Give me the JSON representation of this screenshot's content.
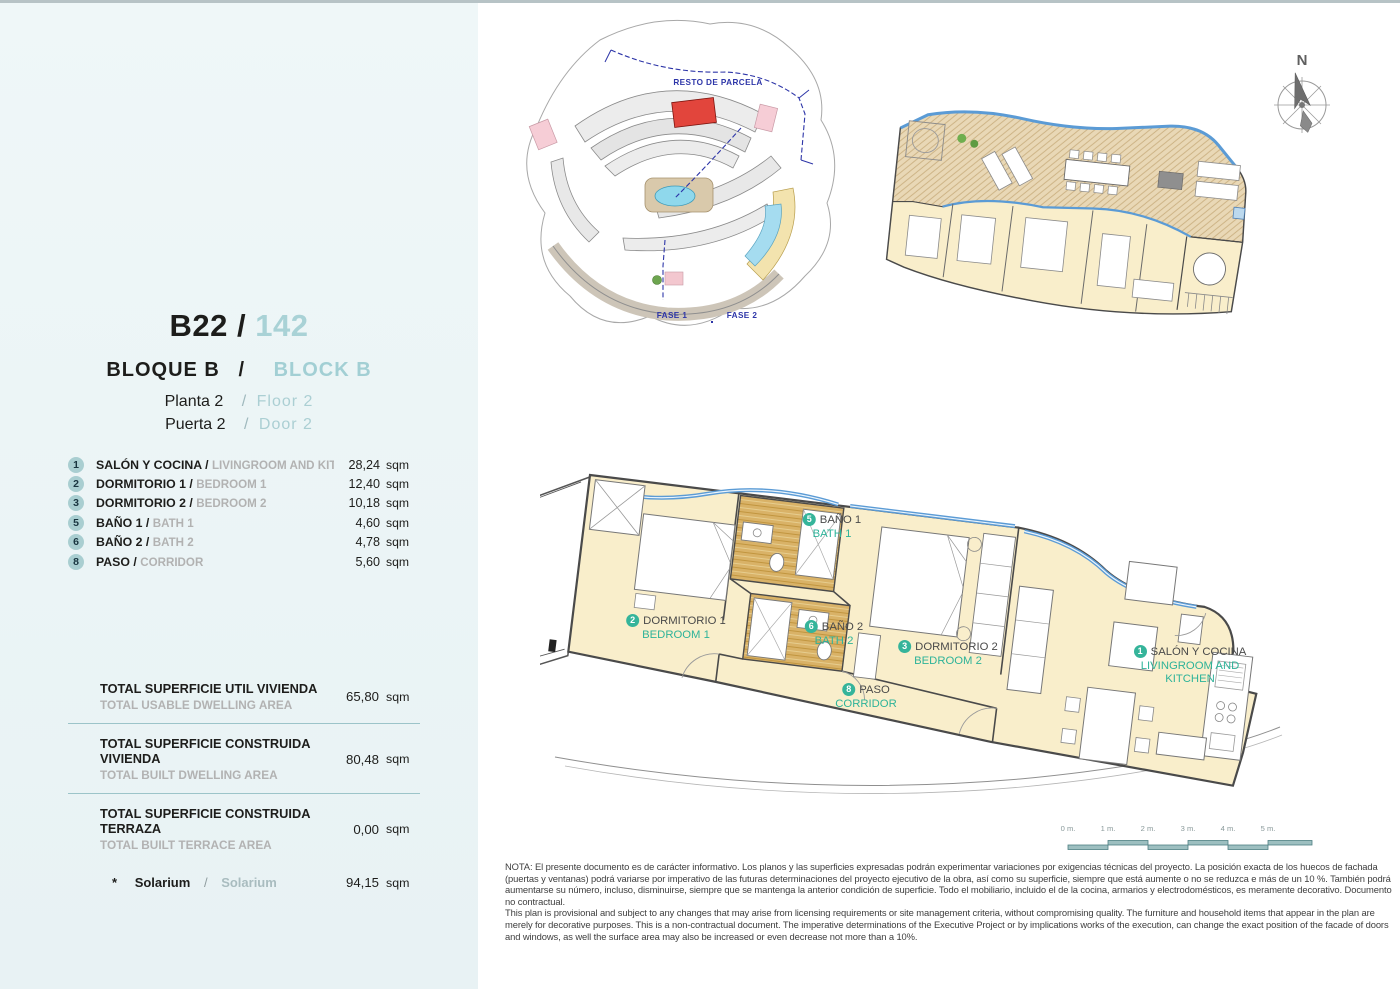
{
  "ui": {
    "slash": "/"
  },
  "sidebar": {
    "unit": {
      "code": "B22 /",
      "number": "142"
    },
    "block": {
      "es": "BLOQUE  B",
      "en": "BLOCK  B"
    },
    "floor": {
      "es": "Planta 2",
      "en": "Floor  2"
    },
    "door": {
      "es": "Puerta 2",
      "en": "Door  2"
    },
    "rooms": [
      {
        "num": "1",
        "name_es": "SALÓN Y COCINA /",
        "name_en": "LIVINGROOM AND KITCHEN",
        "area": "28,24",
        "unit": "sqm"
      },
      {
        "num": "2",
        "name_es": "DORMITORIO 1 /",
        "name_en": "BEDROOM 1",
        "area": "12,40",
        "unit": "sqm"
      },
      {
        "num": "3",
        "name_es": "DORMITORIO 2 /",
        "name_en": "BEDROOM 2",
        "area": "10,18",
        "unit": "sqm"
      },
      {
        "num": "5",
        "name_es": "BAÑO 1 /",
        "name_en": "BATH 1",
        "area": "4,60",
        "unit": "sqm"
      },
      {
        "num": "6",
        "name_es": "BAÑO 2 /",
        "name_en": "BATH 2",
        "area": "4,78",
        "unit": "sqm"
      },
      {
        "num": "8",
        "name_es": "PASO /",
        "name_en": "CORRIDOR",
        "area": "5,60",
        "unit": "sqm"
      }
    ],
    "totals": [
      {
        "label_es": "TOTAL SUPERFICIE UTIL VIVIENDA",
        "label_en": "TOTAL USABLE DWELLING AREA",
        "value": "65,80",
        "unit": "sqm"
      },
      {
        "label_es": "TOTAL SUPERFICIE CONSTRUIDA VIVIENDA",
        "label_en": "TOTAL BUILT DWELLING AREA",
        "value": "80,48",
        "unit": "sqm"
      },
      {
        "label_es": "TOTAL SUPERFICIE CONSTRUIDA TERRAZA",
        "label_en": "TOTAL BUILT TERRACE AREA",
        "value": "0,00",
        "unit": "sqm"
      }
    ],
    "solarium": {
      "star": "*",
      "label_es": "Solarium",
      "label_en": "Solarium",
      "value": "94,15",
      "unit": "sqm"
    }
  },
  "site_plan": {
    "resto_label": "RESTO DE PARCELA",
    "fase1_label": "FASE 1",
    "fase2_label": "FASE 2"
  },
  "compass": {
    "north": "N"
  },
  "floor_plan": {
    "labels": [
      {
        "num": "1",
        "name_es": "SALÓN Y COCINA",
        "name_en": "LIVINGROOM AND KITCHEN"
      },
      {
        "num": "2",
        "name_es": "DORMITORIO 1",
        "name_en": "BEDROOM 1"
      },
      {
        "num": "3",
        "name_es": "DORMITORIO 2",
        "name_en": "BEDROOM 2"
      },
      {
        "num": "5",
        "name_es": "BAÑO 1",
        "name_en": "BATH 1"
      },
      {
        "num": "6",
        "name_es": "BAÑO 2",
        "name_en": "BATH 2"
      },
      {
        "num": "8",
        "name_es": "PASO",
        "name_en": "CORRIDOR"
      }
    ]
  },
  "scale_bar": {
    "labels": [
      "0 m.",
      "1 m.",
      "2 m.",
      "3 m.",
      "4 m.",
      "5 m."
    ]
  },
  "note": {
    "es": "NOTA: El presente documento es de carácter informativo. Los planos y las superficies expresadas podrán experimentar variaciones por exigencias técnicas del proyecto. La posición exacta de los huecos de fachada (puertas y ventanas) podrá variarse por imperativo de las futuras determinaciones del proyecto ejecutivo de la obra, así como su superficie, siempre que está aumente o no se reduzca e más de un 10 %. También podrá aumentarse su número, incluso, disminuirse, siempre que se mantenga la anterior condición de superficie. Todo el mobiliario, incluido el de la cocina, armarios y electrodomésticos, es meramente decorativo. Documento no contractual.",
    "en": "This plan is provisional and subject to any changes that may arise from licensing requirements or site management criteria, without compromising quality. The furniture and household items that appear in the plan are merely for decorative purposes. This is a non-contractual document. The imperative determinations of the Executive Project or by implications works of the execution, can change the exact position of the facade of doors and windows, as well the surface area may also be increased or even decrease not more than a 10%."
  },
  "colors": {
    "sidebar_bg": "#ecf5f6",
    "accent_teal_light": "#a9d2d6",
    "plan_label_teal": "#2eb399",
    "circle_sidebar_bg": "#a9ced1",
    "floor_cream": "#f9eecb",
    "bath_floor_tan": "#d9b267",
    "glazing_blue": "#5b9bd5",
    "highlight_red": "#e2453c",
    "scale_teal": "#9dbfc0",
    "note_text": "#3e3e3e"
  }
}
